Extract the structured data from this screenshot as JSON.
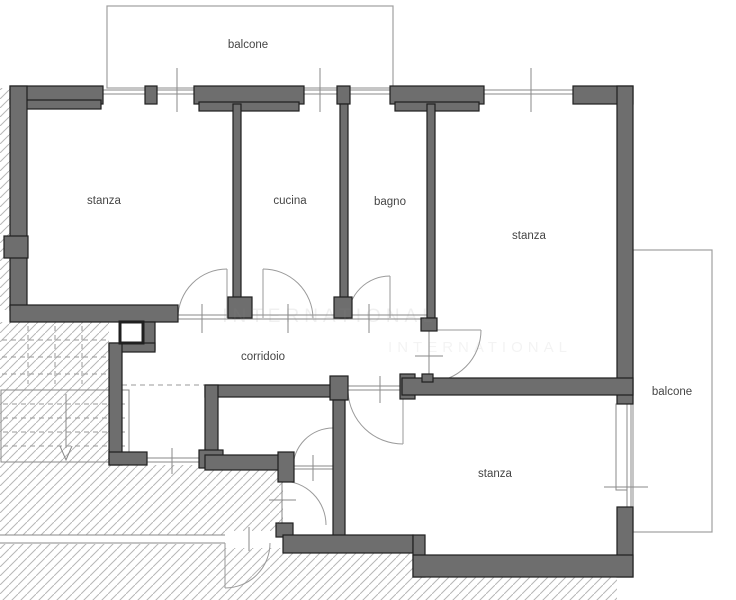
{
  "plan": {
    "title": "apartment floor plan",
    "labels": {
      "balcony_top": "balcone",
      "room_top_left": "stanza",
      "kitchen": "cucina",
      "bathroom": "bagno",
      "room_top_right": "stanza",
      "corridor": "corridoio",
      "room_bottom": "stanza",
      "balcony_right": "balcone",
      "watermark": "INTERNATIONAL"
    },
    "colors": {
      "wall_fill": "#6e6e6e",
      "wall_edge": "#1f1f1f",
      "thin_line": "#8a8a8a",
      "hatch": "#b7b7b7",
      "text": "#454545",
      "background": "#ffffff"
    }
  }
}
